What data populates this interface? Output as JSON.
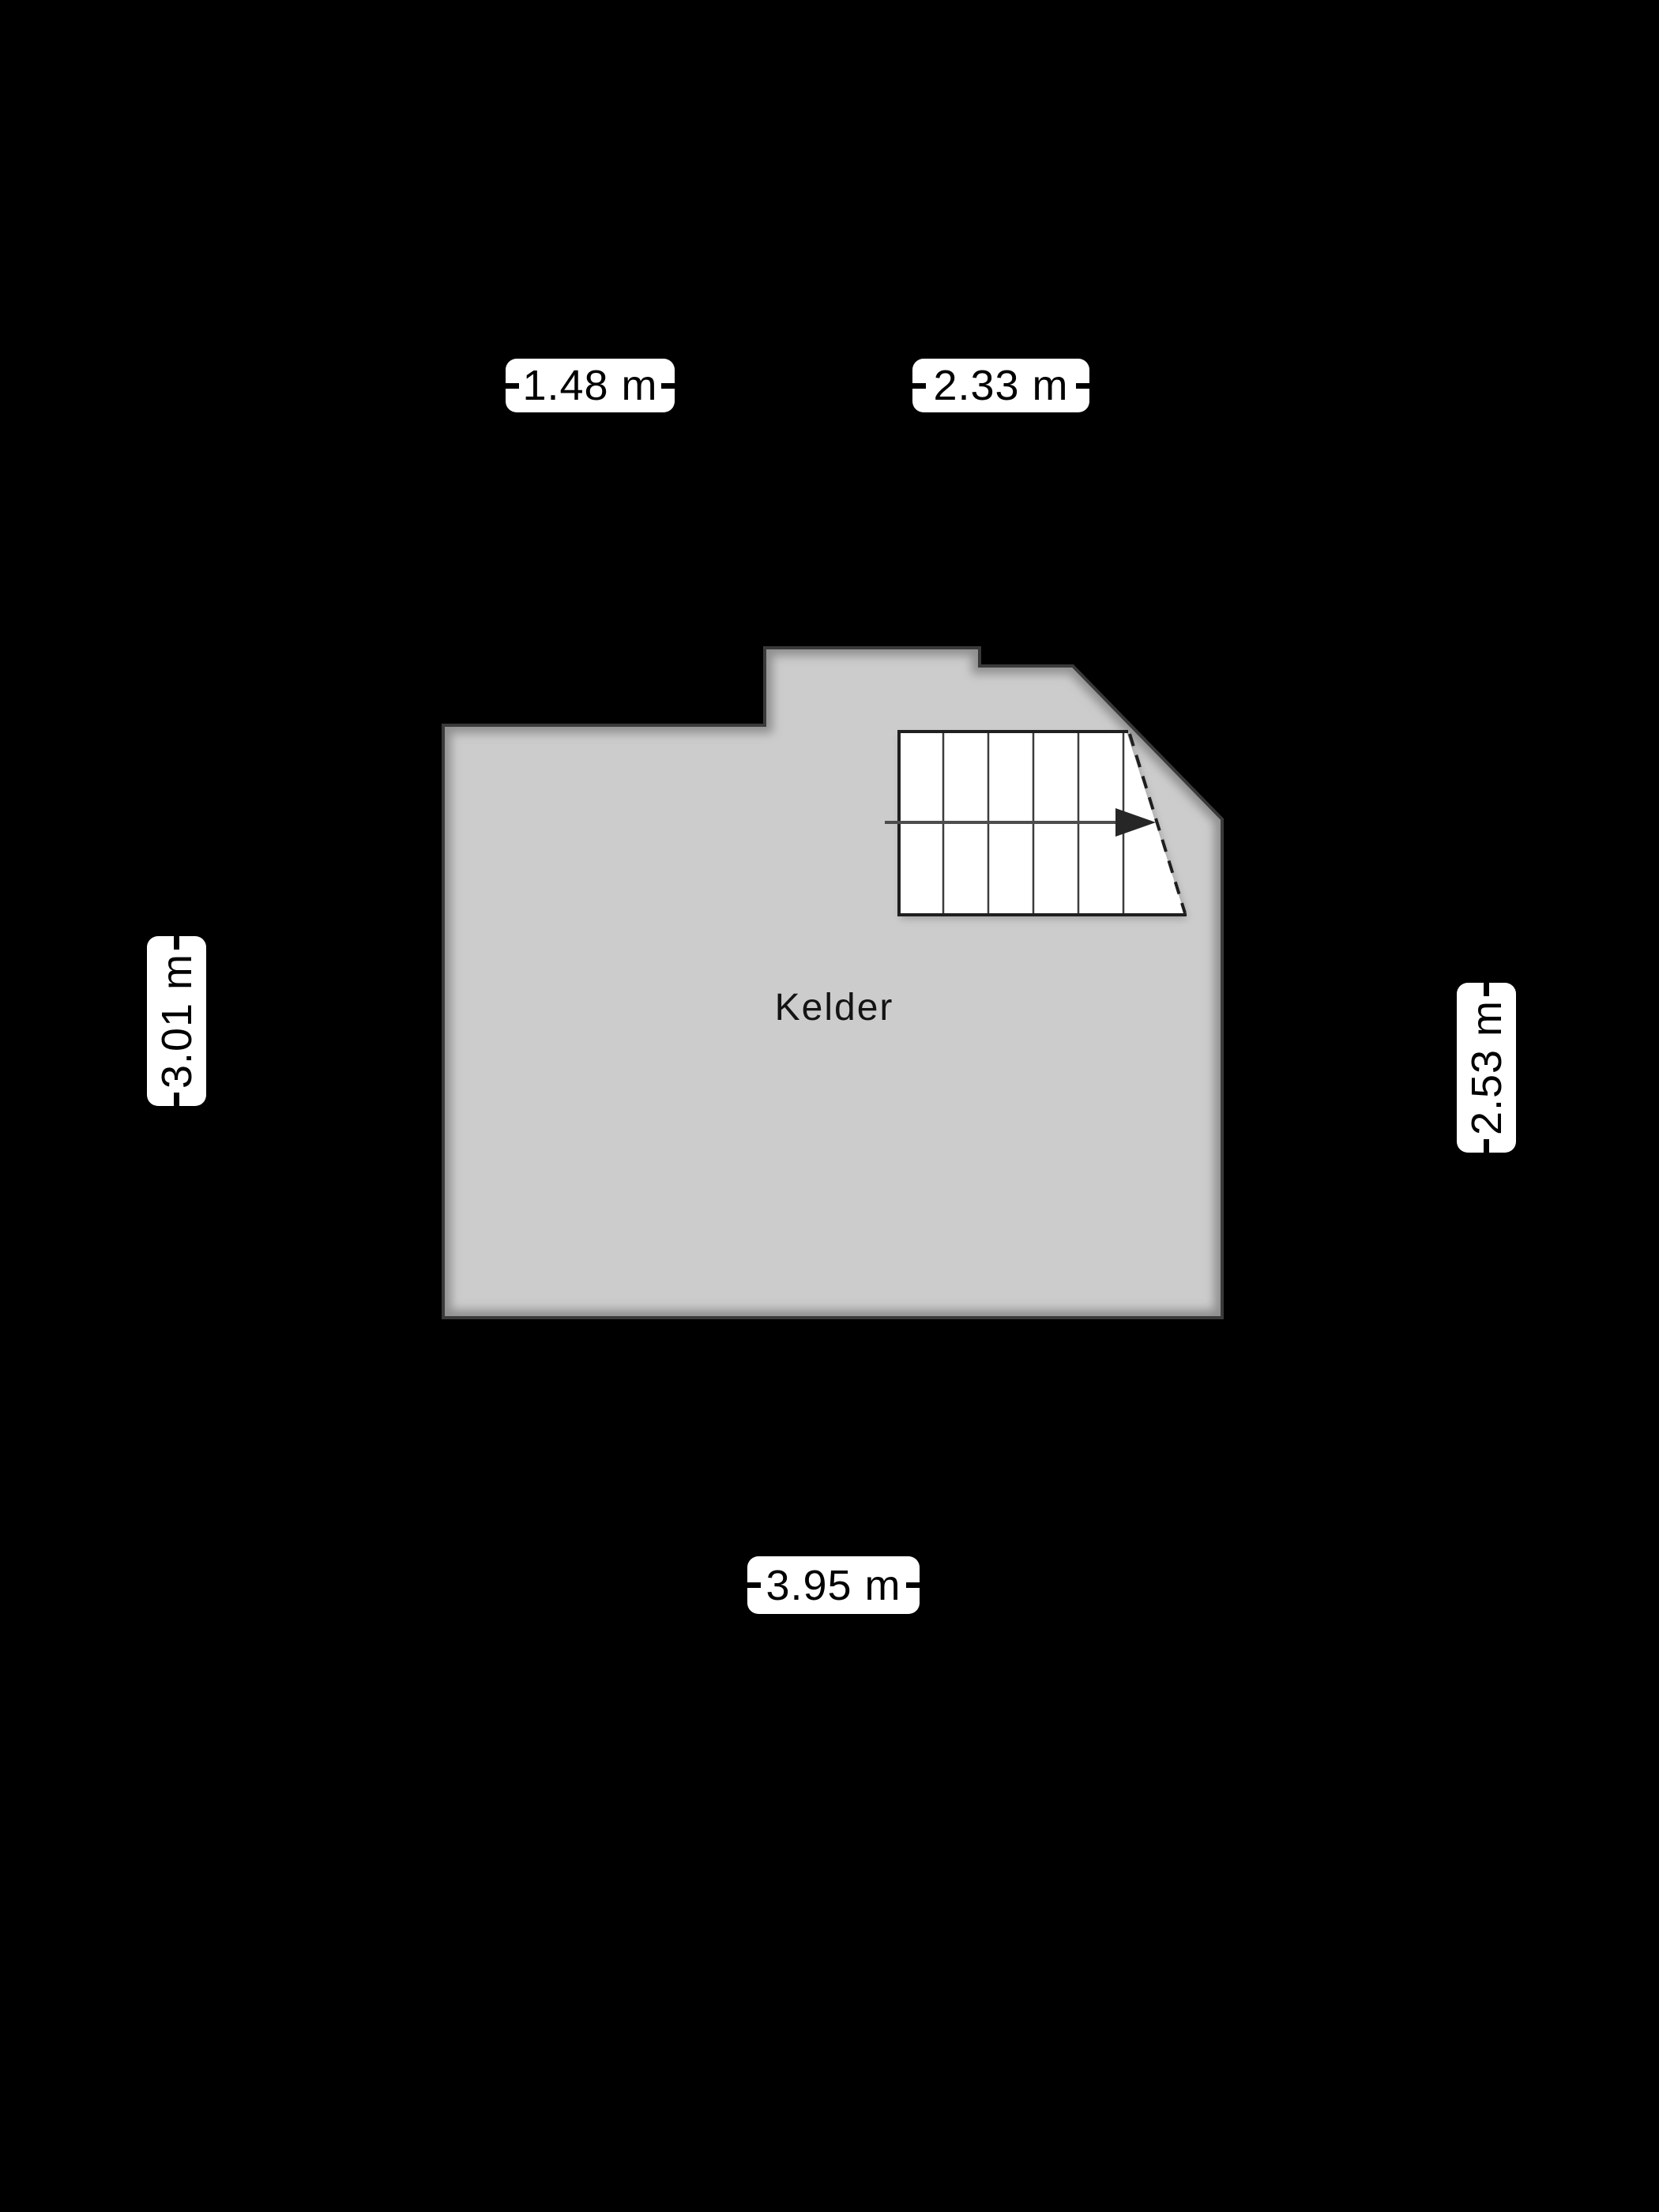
{
  "page": {
    "background_color": "#000000"
  },
  "floorplan": {
    "room": {
      "name": "Kelder",
      "fill_color": "#cccccc",
      "outline_color": "#3a3a3a",
      "inner_shadow_color": "#8f8f8f"
    },
    "dimensions": {
      "top_left": "1.48 m",
      "top_right": "2.33 m",
      "left": "3.01 m",
      "right": "2.53 m",
      "bottom": "3.95 m"
    },
    "staircase": {
      "tread_count": 6,
      "fill_color": "#ffffff",
      "edge_color": "#1f1f1f",
      "tread_line_color": "#3c3c3c",
      "walk_line_color": "#4d4d4d",
      "arrow_color": "#262626",
      "direction": "right"
    }
  }
}
